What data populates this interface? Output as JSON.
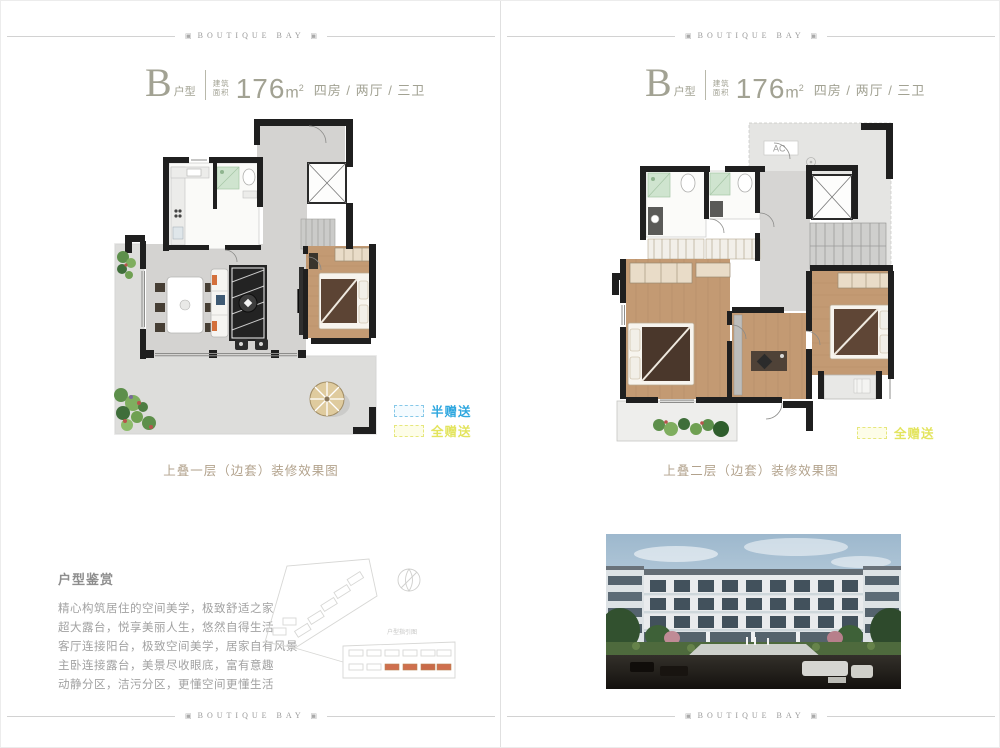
{
  "brand": {
    "text": "BOUTIQUE BAY",
    "ornament": "▣"
  },
  "unit_title": {
    "letter": "B",
    "category": "户型",
    "area_label_top": "建筑",
    "area_label_bottom": "面积",
    "area_value": "176",
    "area_unit": "m",
    "area_sup": "2",
    "layout": "四房 / 两厅 / 三卫"
  },
  "legend": {
    "half_label": "半赠送",
    "full_label": "全赠送"
  },
  "captions": {
    "level1": "上叠一层（边套）装修效果图",
    "level2": "上叠二层（边套）装修效果图"
  },
  "appreciation": {
    "title": "户型鉴赏",
    "lines": [
      "精心构筑居住的空间美学，极致舒适之家",
      "超大露台，悦享美丽人生，悠然自得生活",
      "客厅连接阳台，极致空间美学，居家自有风景",
      "主卧连接露台，美景尽收眼底，富有意趣",
      "动静分区，洁污分区，更懂空间更懂生活"
    ]
  },
  "site_map": {
    "label": "户型指引图"
  },
  "plan_labels": {
    "ac": "AC"
  },
  "colors": {
    "accent_blue": "#2fa7df",
    "accent_yellow": "#e3e45e",
    "title_olive": "#a2a293",
    "wall": "#1f1f1f",
    "wood_floor": "#c39a73",
    "gray_floor": "#d4d3d1"
  }
}
